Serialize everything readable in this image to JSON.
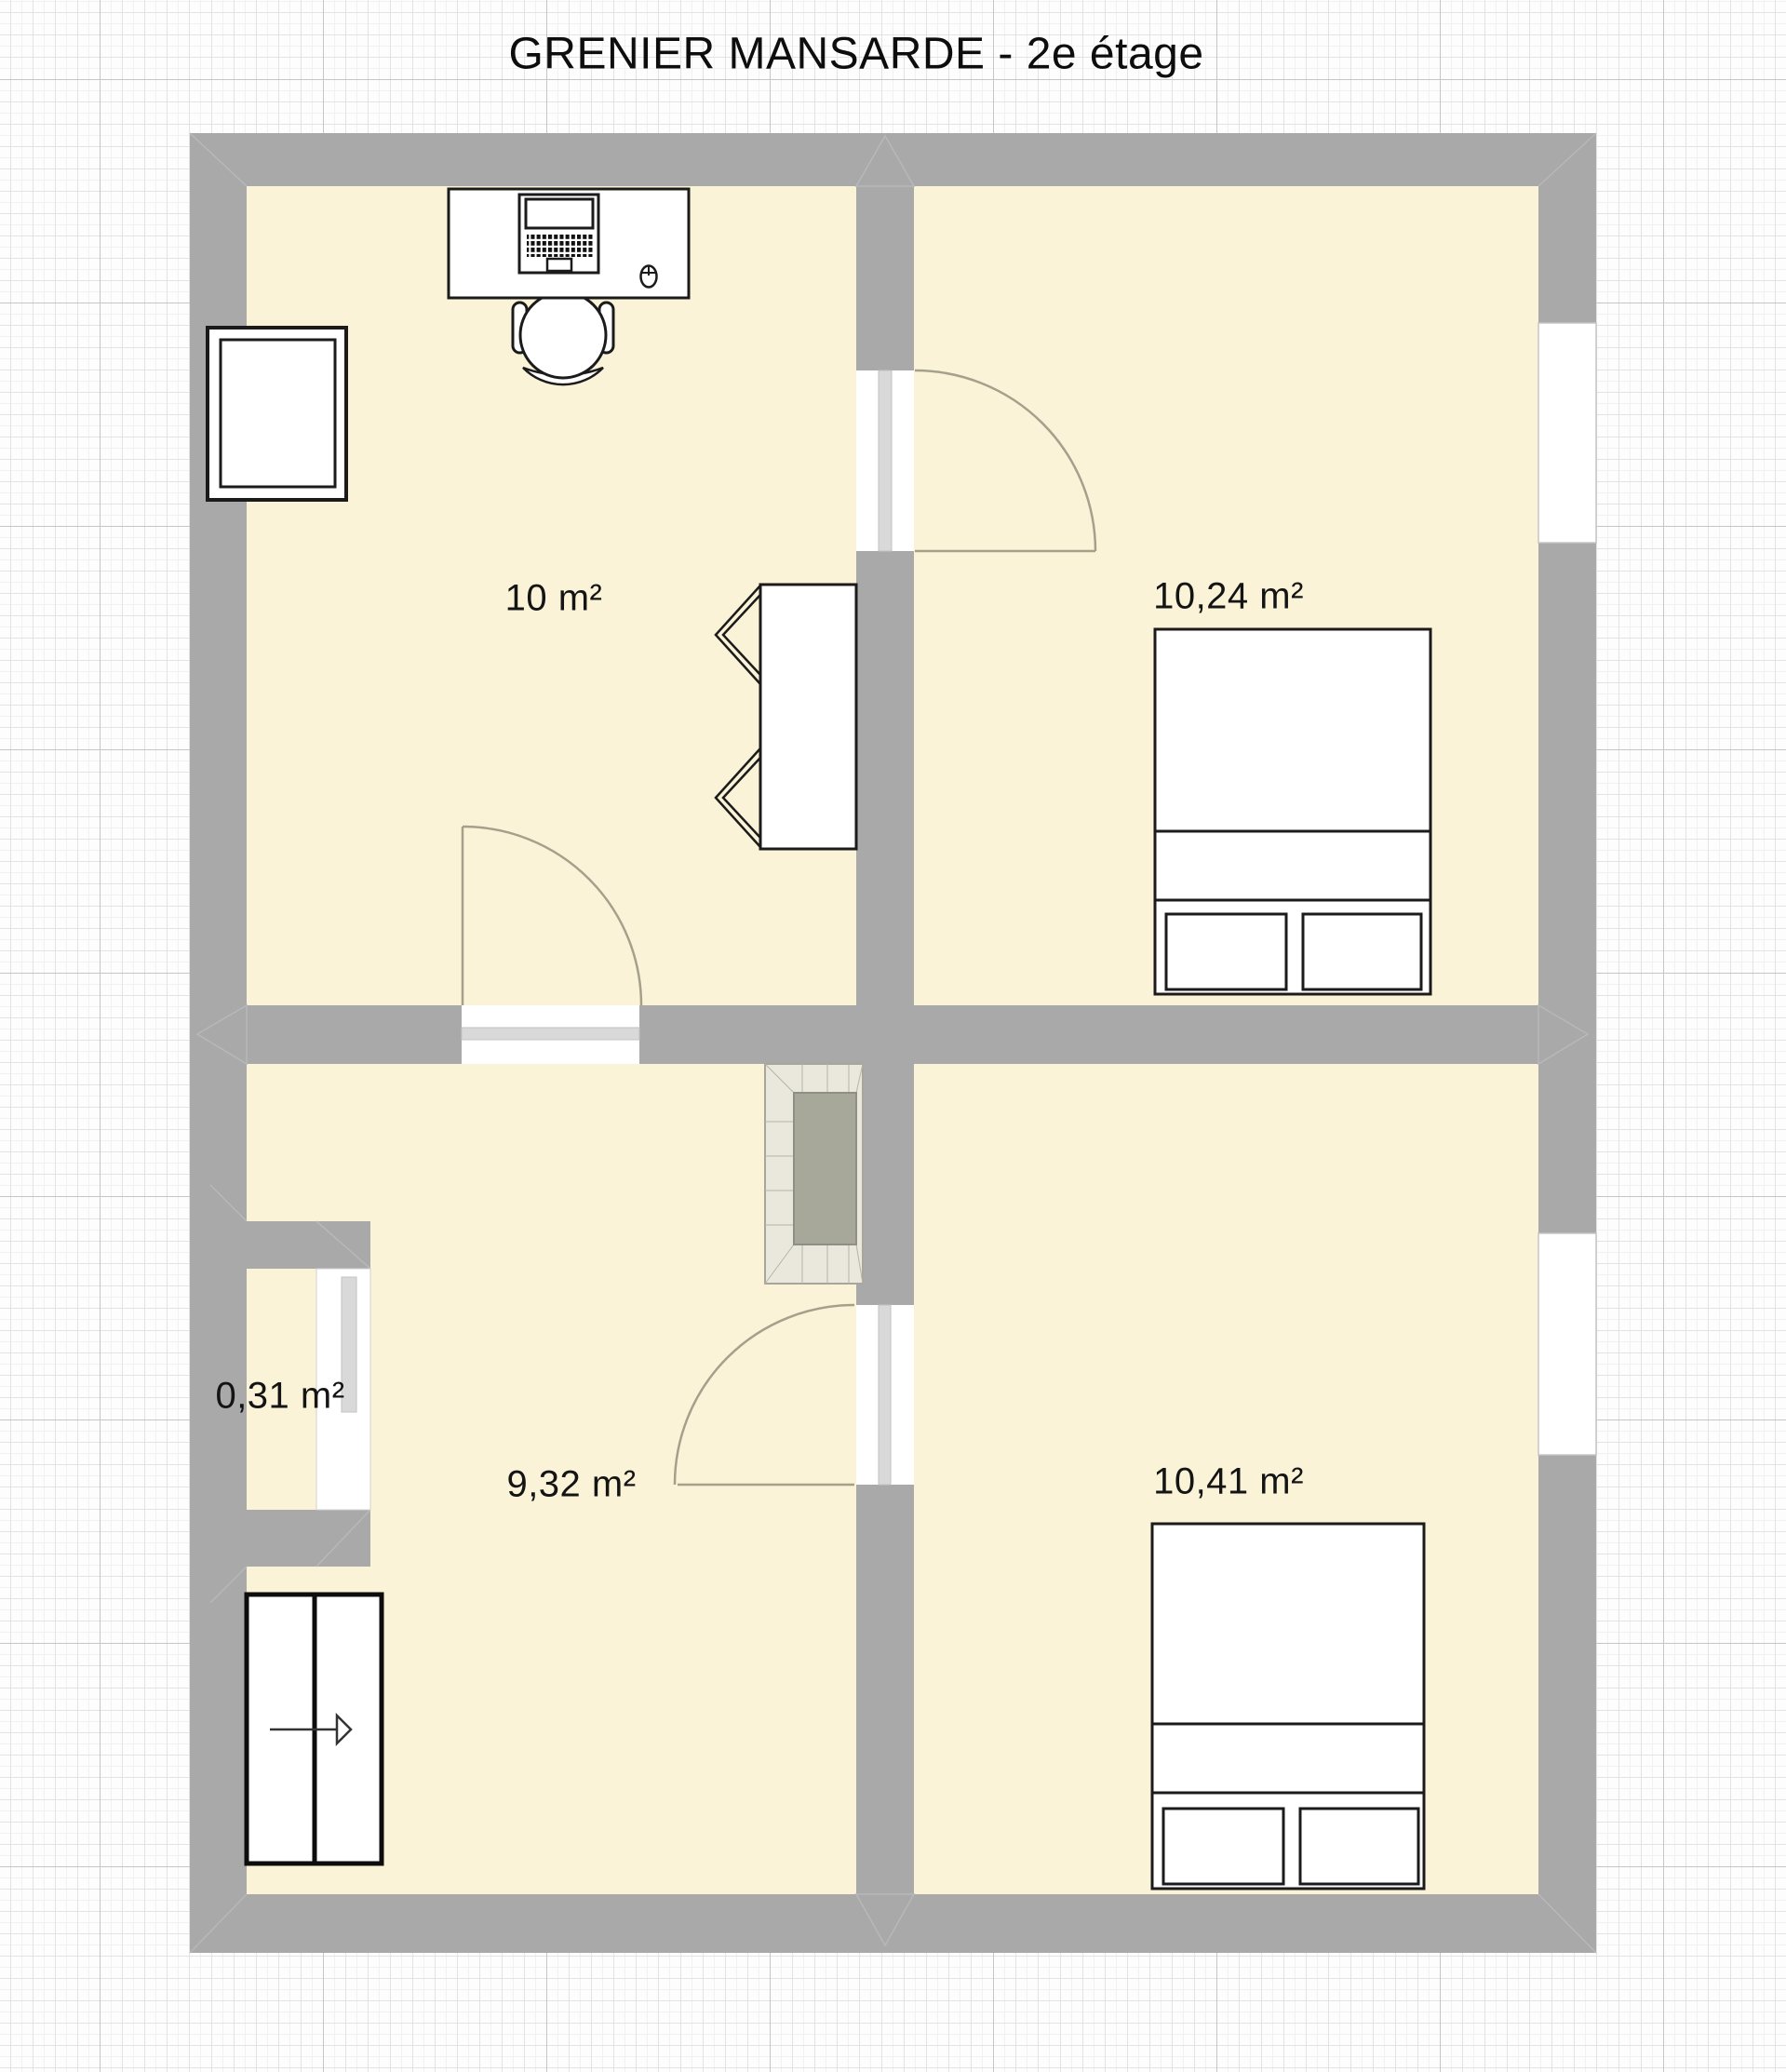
{
  "title": "GRENIER MANSARDE - 2e étage",
  "rooms": [
    {
      "id": "room-top-left",
      "area_label": "10 m²"
    },
    {
      "id": "room-top-right",
      "area_label": "10,24 m²"
    },
    {
      "id": "room-closet",
      "area_label": "0,31 m²"
    },
    {
      "id": "room-bottom-left",
      "area_label": "9,32 m²"
    },
    {
      "id": "room-bottom-right",
      "area_label": "10,41 m²"
    }
  ],
  "furniture": [
    "desk",
    "laptop",
    "mouse",
    "office-chair",
    "wardrobe",
    "roof-window",
    "double-bed",
    "double-bed",
    "chimney",
    "stairs-hatch"
  ],
  "colors": {
    "wall": "#a9a9a9",
    "floor": "#faf3d7",
    "grid_major": "#c6c6c6",
    "grid_minor": "#e3e3e3",
    "door_leaf": "#d9d9d9",
    "door_arc": "#a5a08c",
    "chimney_brick": "#eae8dd",
    "chimney_flue": "#a7a89a",
    "furniture_stroke": "#1b1b1b"
  }
}
